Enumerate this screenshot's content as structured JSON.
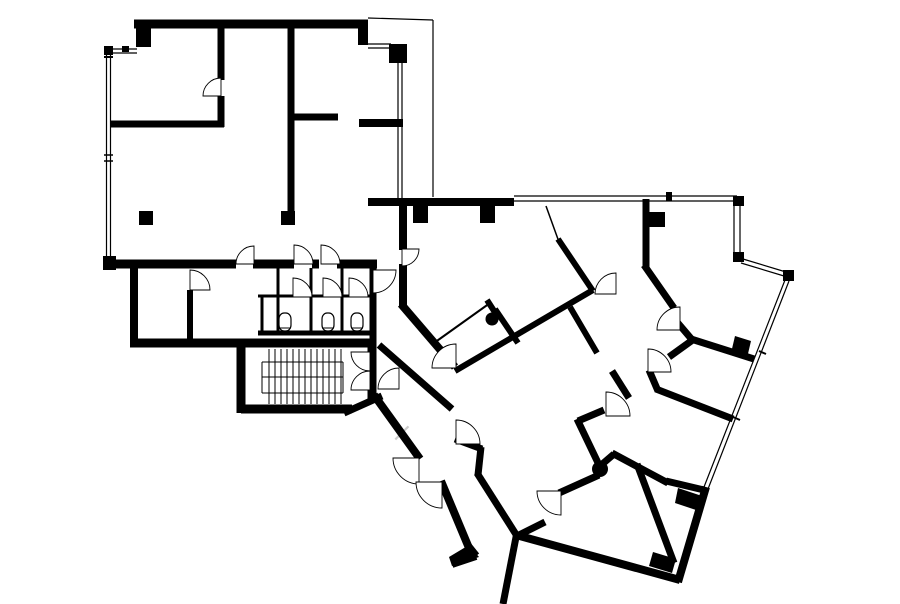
{
  "canvas": {
    "width": 900,
    "height": 604,
    "background": "#ffffff",
    "ink": "#000000"
  },
  "watermark": {
    "glyph": "×",
    "x": 391,
    "y": 441,
    "size": 26,
    "color": "#cccccc"
  },
  "plan": {
    "walls": [
      [
        134,
        24,
        368,
        24,
        9
      ],
      [
        106,
        49,
        137,
        49,
        1.2
      ],
      [
        106,
        53,
        137,
        53,
        1.2
      ],
      [
        106.5,
        47,
        106.5,
        263,
        1.2
      ],
      [
        110.5,
        47,
        110.5,
        263,
        1.2
      ],
      [
        104,
        57,
        113,
        57,
        2
      ],
      [
        104,
        155,
        113,
        155,
        1.5
      ],
      [
        104,
        161,
        113,
        161,
        1.5
      ],
      [
        221,
        20,
        221,
        80,
        7
      ],
      [
        221,
        96,
        221,
        127,
        7
      ],
      [
        110,
        124,
        224,
        124,
        7
      ],
      [
        291,
        20,
        291,
        221,
        7
      ],
      [
        291,
        117,
        338,
        117,
        7
      ],
      [
        368,
        44,
        391,
        44,
        1.2
      ],
      [
        368,
        48,
        391,
        48,
        1.2
      ],
      [
        398,
        63,
        398,
        198,
        1.2
      ],
      [
        402,
        63,
        402,
        198,
        1.2
      ],
      [
        359,
        123,
        403,
        123,
        8
      ],
      [
        368,
        18,
        433,
        20,
        1.2
      ],
      [
        433,
        20,
        433,
        197,
        1.2
      ],
      [
        107,
        264,
        236,
        264,
        9
      ],
      [
        253,
        264,
        294,
        264,
        9
      ],
      [
        312,
        264,
        319,
        264,
        9
      ],
      [
        337,
        264,
        377,
        264,
        9
      ],
      [
        134,
        268,
        134,
        344,
        8
      ],
      [
        190,
        290,
        190,
        344,
        6
      ],
      [
        130,
        343,
        373,
        343,
        9
      ],
      [
        373,
        264,
        373,
        339,
        7
      ],
      [
        258,
        296,
        294,
        296,
        3
      ],
      [
        312,
        296,
        324,
        296,
        3
      ],
      [
        342,
        296,
        350,
        296,
        3
      ],
      [
        368,
        296,
        372,
        296,
        3
      ],
      [
        278,
        268,
        278,
        331,
        3
      ],
      [
        311,
        268,
        311,
        331,
        3
      ],
      [
        342,
        268,
        342,
        331,
        3
      ],
      [
        262,
        296,
        262,
        331,
        3
      ],
      [
        258,
        333,
        373,
        333,
        5
      ],
      [
        241,
        339,
        241,
        413,
        9
      ],
      [
        241,
        409,
        352,
        409,
        9
      ],
      [
        372,
        339,
        372,
        399,
        9
      ],
      [
        344,
        413,
        382,
        396,
        7
      ],
      [
        374,
        395,
        420,
        459,
        8
      ],
      [
        441,
        481,
        469,
        548,
        8
      ],
      [
        468,
        546,
        476,
        556,
        8
      ],
      [
        476,
        556,
        452,
        564,
        8
      ],
      [
        379,
        345,
        452,
        409,
        7
      ],
      [
        455,
        439,
        482,
        449,
        7
      ],
      [
        481,
        447,
        478,
        475,
        7
      ],
      [
        477,
        473,
        517,
        536,
        7
      ],
      [
        403,
        200,
        403,
        250,
        8
      ],
      [
        403,
        264,
        403,
        306,
        8
      ],
      [
        401,
        304,
        455,
        367,
        8
      ],
      [
        455,
        371,
        593,
        290,
        6
      ],
      [
        570,
        307,
        597,
        353,
        6
      ],
      [
        558,
        239,
        593,
        291,
        6
      ],
      [
        546,
        206,
        559,
        242,
        1.5
      ],
      [
        646,
        199,
        646,
        268,
        7
      ],
      [
        644,
        265,
        674,
        308,
        7
      ],
      [
        677,
        322,
        694,
        342,
        7
      ],
      [
        691,
        339,
        754,
        359,
        7
      ],
      [
        694,
        339,
        669,
        357,
        7
      ],
      [
        649,
        370,
        658,
        391,
        7
      ],
      [
        656,
        389,
        733,
        419,
        7
      ],
      [
        612,
        371,
        629,
        398,
        7
      ],
      [
        604,
        410,
        578,
        421,
        7
      ],
      [
        577,
        419,
        600,
        467,
        7
      ],
      [
        600,
        466,
        614,
        454,
        7
      ],
      [
        612,
        453,
        668,
        483,
        7
      ],
      [
        666,
        481,
        704,
        490,
        7
      ],
      [
        559,
        493,
        599,
        475,
        7
      ],
      [
        517,
        536,
        545,
        522,
        7
      ],
      [
        517,
        532,
        503,
        604,
        7
      ],
      [
        516,
        535,
        680,
        580,
        8
      ],
      [
        637,
        464,
        674,
        563,
        7
      ],
      [
        678,
        582,
        706,
        487,
        8
      ],
      [
        368,
        202,
        514,
        202,
        8
      ],
      [
        514,
        196,
        737,
        196,
        1.2
      ],
      [
        514,
        201,
        737,
        201,
        1.2
      ],
      [
        734,
        206,
        734,
        254,
        1.2
      ],
      [
        740,
        206,
        740,
        254,
        1.2
      ],
      [
        743,
        259,
        786,
        272,
        1.2
      ],
      [
        741,
        263,
        784,
        276,
        1.2
      ],
      [
        789,
        281,
        708,
        489,
        1.2
      ],
      [
        785,
        280,
        704,
        487,
        1.2
      ],
      [
        759,
        351,
        766,
        354,
        2
      ],
      [
        733,
        417,
        740,
        420,
        2
      ],
      [
        434,
        343,
        490,
        303,
        2
      ],
      [
        487,
        300,
        496,
        314,
        6
      ],
      [
        495,
        309,
        518,
        343,
        6
      ]
    ],
    "pillars": [
      {
        "x": 136,
        "y": 28,
        "w": 15,
        "h": 19
      },
      {
        "x": 358,
        "y": 28,
        "w": 10,
        "h": 17
      },
      {
        "x": 104,
        "y": 46,
        "w": 9,
        "h": 9
      },
      {
        "x": 122,
        "y": 46,
        "w": 7,
        "h": 6
      },
      {
        "x": 103,
        "y": 256,
        "w": 13,
        "h": 14
      },
      {
        "x": 281,
        "y": 211,
        "w": 14,
        "h": 14
      },
      {
        "x": 139,
        "y": 211,
        "w": 14,
        "h": 14
      },
      {
        "x": 389,
        "y": 44,
        "w": 18,
        "h": 19
      },
      {
        "x": 413,
        "y": 206,
        "w": 15,
        "h": 17
      },
      {
        "x": 480,
        "y": 206,
        "w": 15,
        "h": 17
      },
      {
        "x": 648,
        "y": 212,
        "w": 17,
        "h": 15
      },
      {
        "x": 733,
        "y": 196,
        "w": 11,
        "h": 10
      },
      {
        "x": 733,
        "y": 252,
        "w": 11,
        "h": 10
      },
      {
        "x": 783,
        "y": 270,
        "w": 11,
        "h": 11
      },
      {
        "x": 666,
        "y": 192,
        "w": 6,
        "h": 9
      }
    ],
    "polygons": [
      [
        [
          735,
          336
        ],
        [
          751,
          341
        ],
        [
          747,
          358
        ],
        [
          731,
          353
        ]
      ],
      [
        [
          678,
          488
        ],
        [
          702,
          496
        ],
        [
          699,
          511
        ],
        [
          675,
          503
        ]
      ],
      [
        [
          653,
          552
        ],
        [
          676,
          559
        ],
        [
          672,
          573
        ],
        [
          649,
          566
        ]
      ],
      [
        [
          469,
          545
        ],
        [
          479,
          557
        ],
        [
          452,
          566
        ],
        [
          449,
          557
        ]
      ]
    ],
    "columns": [
      {
        "cx": 600,
        "cy": 469,
        "r": 8
      },
      {
        "cx": 492,
        "cy": 319,
        "r": 6.5
      }
    ],
    "doors": [
      {
        "cx": 221,
        "cy": 96,
        "r": 18,
        "a0": 180,
        "a1": 270
      },
      {
        "cx": 254,
        "cy": 264,
        "r": 18,
        "a0": 180,
        "a1": 270
      },
      {
        "cx": 294,
        "cy": 264,
        "r": 19,
        "a0": 270,
        "a1": 360
      },
      {
        "cx": 321,
        "cy": 264,
        "r": 19,
        "a0": 270,
        "a1": 360
      },
      {
        "cx": 293,
        "cy": 297,
        "r": 19,
        "a0": 270,
        "a1": 360
      },
      {
        "cx": 323,
        "cy": 297,
        "r": 19,
        "a0": 270,
        "a1": 360
      },
      {
        "cx": 349,
        "cy": 297,
        "r": 19,
        "a0": 270,
        "a1": 360
      },
      {
        "cx": 190,
        "cy": 290,
        "r": 20,
        "a0": 270,
        "a1": 360
      },
      {
        "cx": 373,
        "cy": 270,
        "r": 23,
        "a0": 0,
        "a1": 90
      },
      {
        "cx": 370,
        "cy": 352,
        "r": 19,
        "a0": 90,
        "a1": 180
      },
      {
        "cx": 370,
        "cy": 390,
        "r": 19,
        "a0": 180,
        "a1": 270
      },
      {
        "cx": 402,
        "cy": 249,
        "r": 17,
        "a0": 0,
        "a1": 90
      },
      {
        "cx": 399,
        "cy": 389,
        "r": 21,
        "a0": 180,
        "a1": 270
      },
      {
        "cx": 419,
        "cy": 458,
        "r": 26,
        "a0": 90,
        "a1": 180
      },
      {
        "cx": 442,
        "cy": 482,
        "r": 26,
        "a0": 90,
        "a1": 180
      },
      {
        "cx": 456,
        "cy": 444,
        "r": 24,
        "a0": 270,
        "a1": 360
      },
      {
        "cx": 456,
        "cy": 368,
        "r": 24,
        "a0": 180,
        "a1": 270
      },
      {
        "cx": 616,
        "cy": 294,
        "r": 21,
        "a0": 180,
        "a1": 270
      },
      {
        "cx": 680,
        "cy": 330,
        "r": 23,
        "a0": 180,
        "a1": 270
      },
      {
        "cx": 648,
        "cy": 372,
        "r": 23,
        "a0": 270,
        "a1": 360
      },
      {
        "cx": 606,
        "cy": 416,
        "r": 24,
        "a0": 270,
        "a1": 360
      },
      {
        "cx": 561,
        "cy": 491,
        "r": 24,
        "a0": 90,
        "a1": 180
      }
    ],
    "stairs": {
      "treads": {
        "x0": 269,
        "step": 6,
        "count": 13,
        "y1": 349,
        "y2": 404
      },
      "guides": [
        [
          262,
          362,
          343,
          362
        ],
        [
          262,
          393,
          343,
          393
        ],
        [
          262,
          362,
          262,
          393
        ],
        [
          343,
          362,
          343,
          393
        ],
        [
          262,
          377,
          343,
          377
        ]
      ]
    },
    "toilets": [
      {
        "cx": 285,
        "y": 313,
        "w": 12,
        "h": 18
      },
      {
        "cx": 328,
        "y": 313,
        "w": 12,
        "h": 18
      },
      {
        "cx": 357,
        "y": 313,
        "w": 12,
        "h": 18
      }
    ]
  }
}
